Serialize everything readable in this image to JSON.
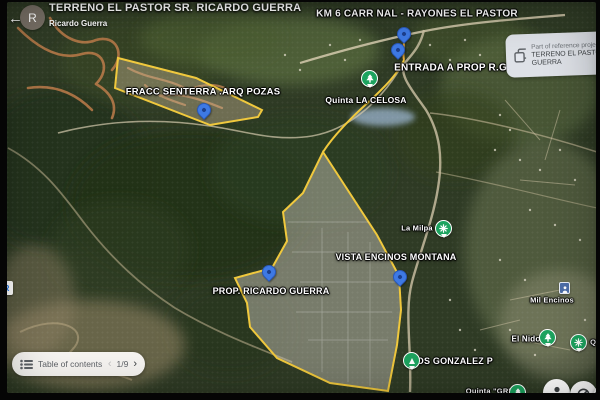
{
  "header": {
    "back_icon": "←",
    "avatar_letter": "R",
    "title": "TERRENO EL PASTOR SR. RICARDO GUERRA",
    "subtitle": "Ricardo Guerra"
  },
  "reference_card": {
    "icon": "overlapping-squares",
    "line1": "Part of reference proje",
    "line2": "TERRENO EL PASTOR",
    "line3": "GUERRA"
  },
  "map_labels": [
    {
      "id": "km6-road",
      "text": "KM 6 CARR NAL - RAYONES EL PASTOR"
    },
    {
      "id": "entrada-prop",
      "text": "ENTRADA A PROP R.G."
    },
    {
      "id": "quinta-la-celosa",
      "text": "Quinta LA CELOSA"
    },
    {
      "id": "fracc-senterra",
      "text": "FRACC SENTERRA .ARQ POZAS"
    },
    {
      "id": "la-milpa",
      "text": "La Milpa"
    },
    {
      "id": "vista-encinos",
      "text": "VISTA ENCINOS MONTANA"
    },
    {
      "id": "prop-ricardo-guerra",
      "text": "PROP. RICARDO GUERRA"
    },
    {
      "id": "mil-encinos",
      "text": "Mil Encinos"
    },
    {
      "id": "el-nido",
      "text": "El Nido"
    },
    {
      "id": "los-gonzalez",
      "text": "LOS GONZALEZ P"
    },
    {
      "id": "quinta-gr",
      "text": "Quinta \"GR\""
    },
    {
      "id": "edge-partial",
      "text": "QU"
    }
  ],
  "toc_bar": {
    "label": "Table of contents",
    "prev_icon": "‹",
    "page_indicator": "1/9",
    "next_icon": "›"
  },
  "fabs": {
    "third_label": "3"
  },
  "edge_badge": {
    "letter": "R"
  },
  "colors": {
    "polygon_stroke": "#f0c83c",
    "pin_blue": "#3e79e4",
    "marker_green": "#1da35f",
    "label_text": "#ffffff",
    "card_bg": "#e4e7ee",
    "toc_bg": "#f7f5f2"
  }
}
